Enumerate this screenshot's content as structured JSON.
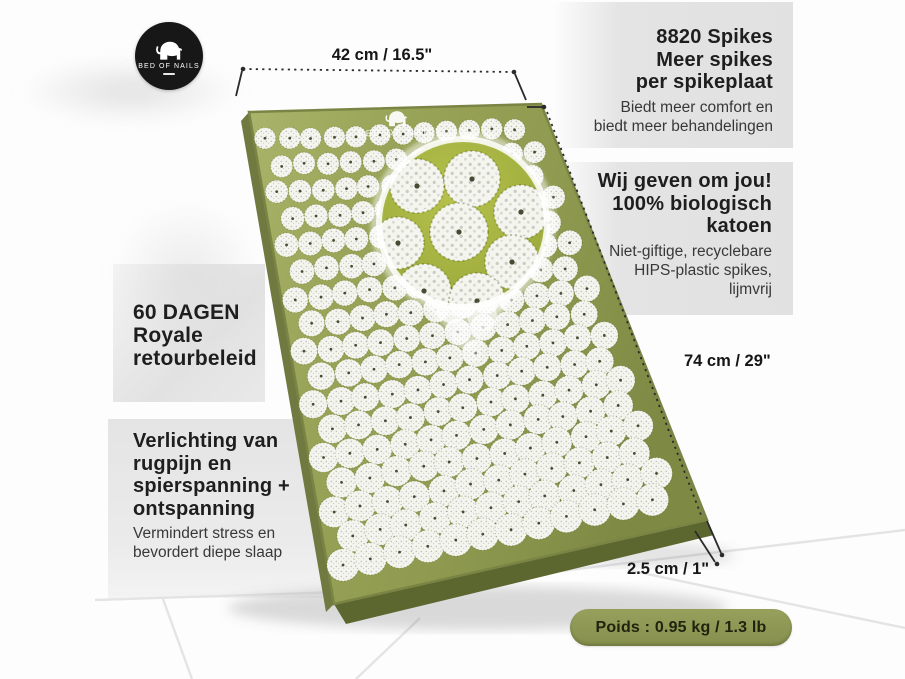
{
  "brand": {
    "logo_text": "BED OF NAILS",
    "mat_print_text": "BED OF NAILS"
  },
  "dimensions": {
    "width_label": "42 cm / 16.5\"",
    "height_label": "74 cm / 29\"",
    "thickness_label": "2.5 cm / 1\""
  },
  "badge": {
    "text": "Poids : 0.95 kg / 1.3 lb"
  },
  "features": {
    "spikes": {
      "title_lines": [
        "8820 Spikes",
        "Meer spikes",
        "per spikeplaat"
      ],
      "subtitle_lines": [
        "Biedt meer comfort en",
        "biedt meer behandelingen"
      ]
    },
    "care": {
      "title_lines": [
        "Wij geven om jou!",
        "100% biologisch",
        "katoen"
      ],
      "subtitle_lines": [
        "Niet-giftige, recyclebare",
        "HIPS-plastic spikes,",
        "lijmvrij"
      ]
    },
    "returns": {
      "title_lines": [
        "60 DAGEN",
        "Royale",
        "retourbeleid"
      ]
    },
    "relief": {
      "title_lines": [
        "Verlichting van",
        "rugpijn en",
        "spierspanning +",
        "ontspanning"
      ],
      "subtitle_lines": [
        "Vermindert stress en",
        "bevordert diepe slaap"
      ]
    }
  },
  "colors": {
    "mat_green": "#96a156",
    "mat_green_light": "#aab46a",
    "mat_green_dark": "#7e8944",
    "mat_side": "#67713a",
    "mat_side_dark": "#5c662f",
    "inset_green": "#a9b542",
    "disc_white": "#f5f5f0",
    "badge_green": "#8d9355",
    "panel_gray": "#e1e1e1",
    "line_dark": "#2b2b2b",
    "text_dark": "#1e1e1e"
  }
}
